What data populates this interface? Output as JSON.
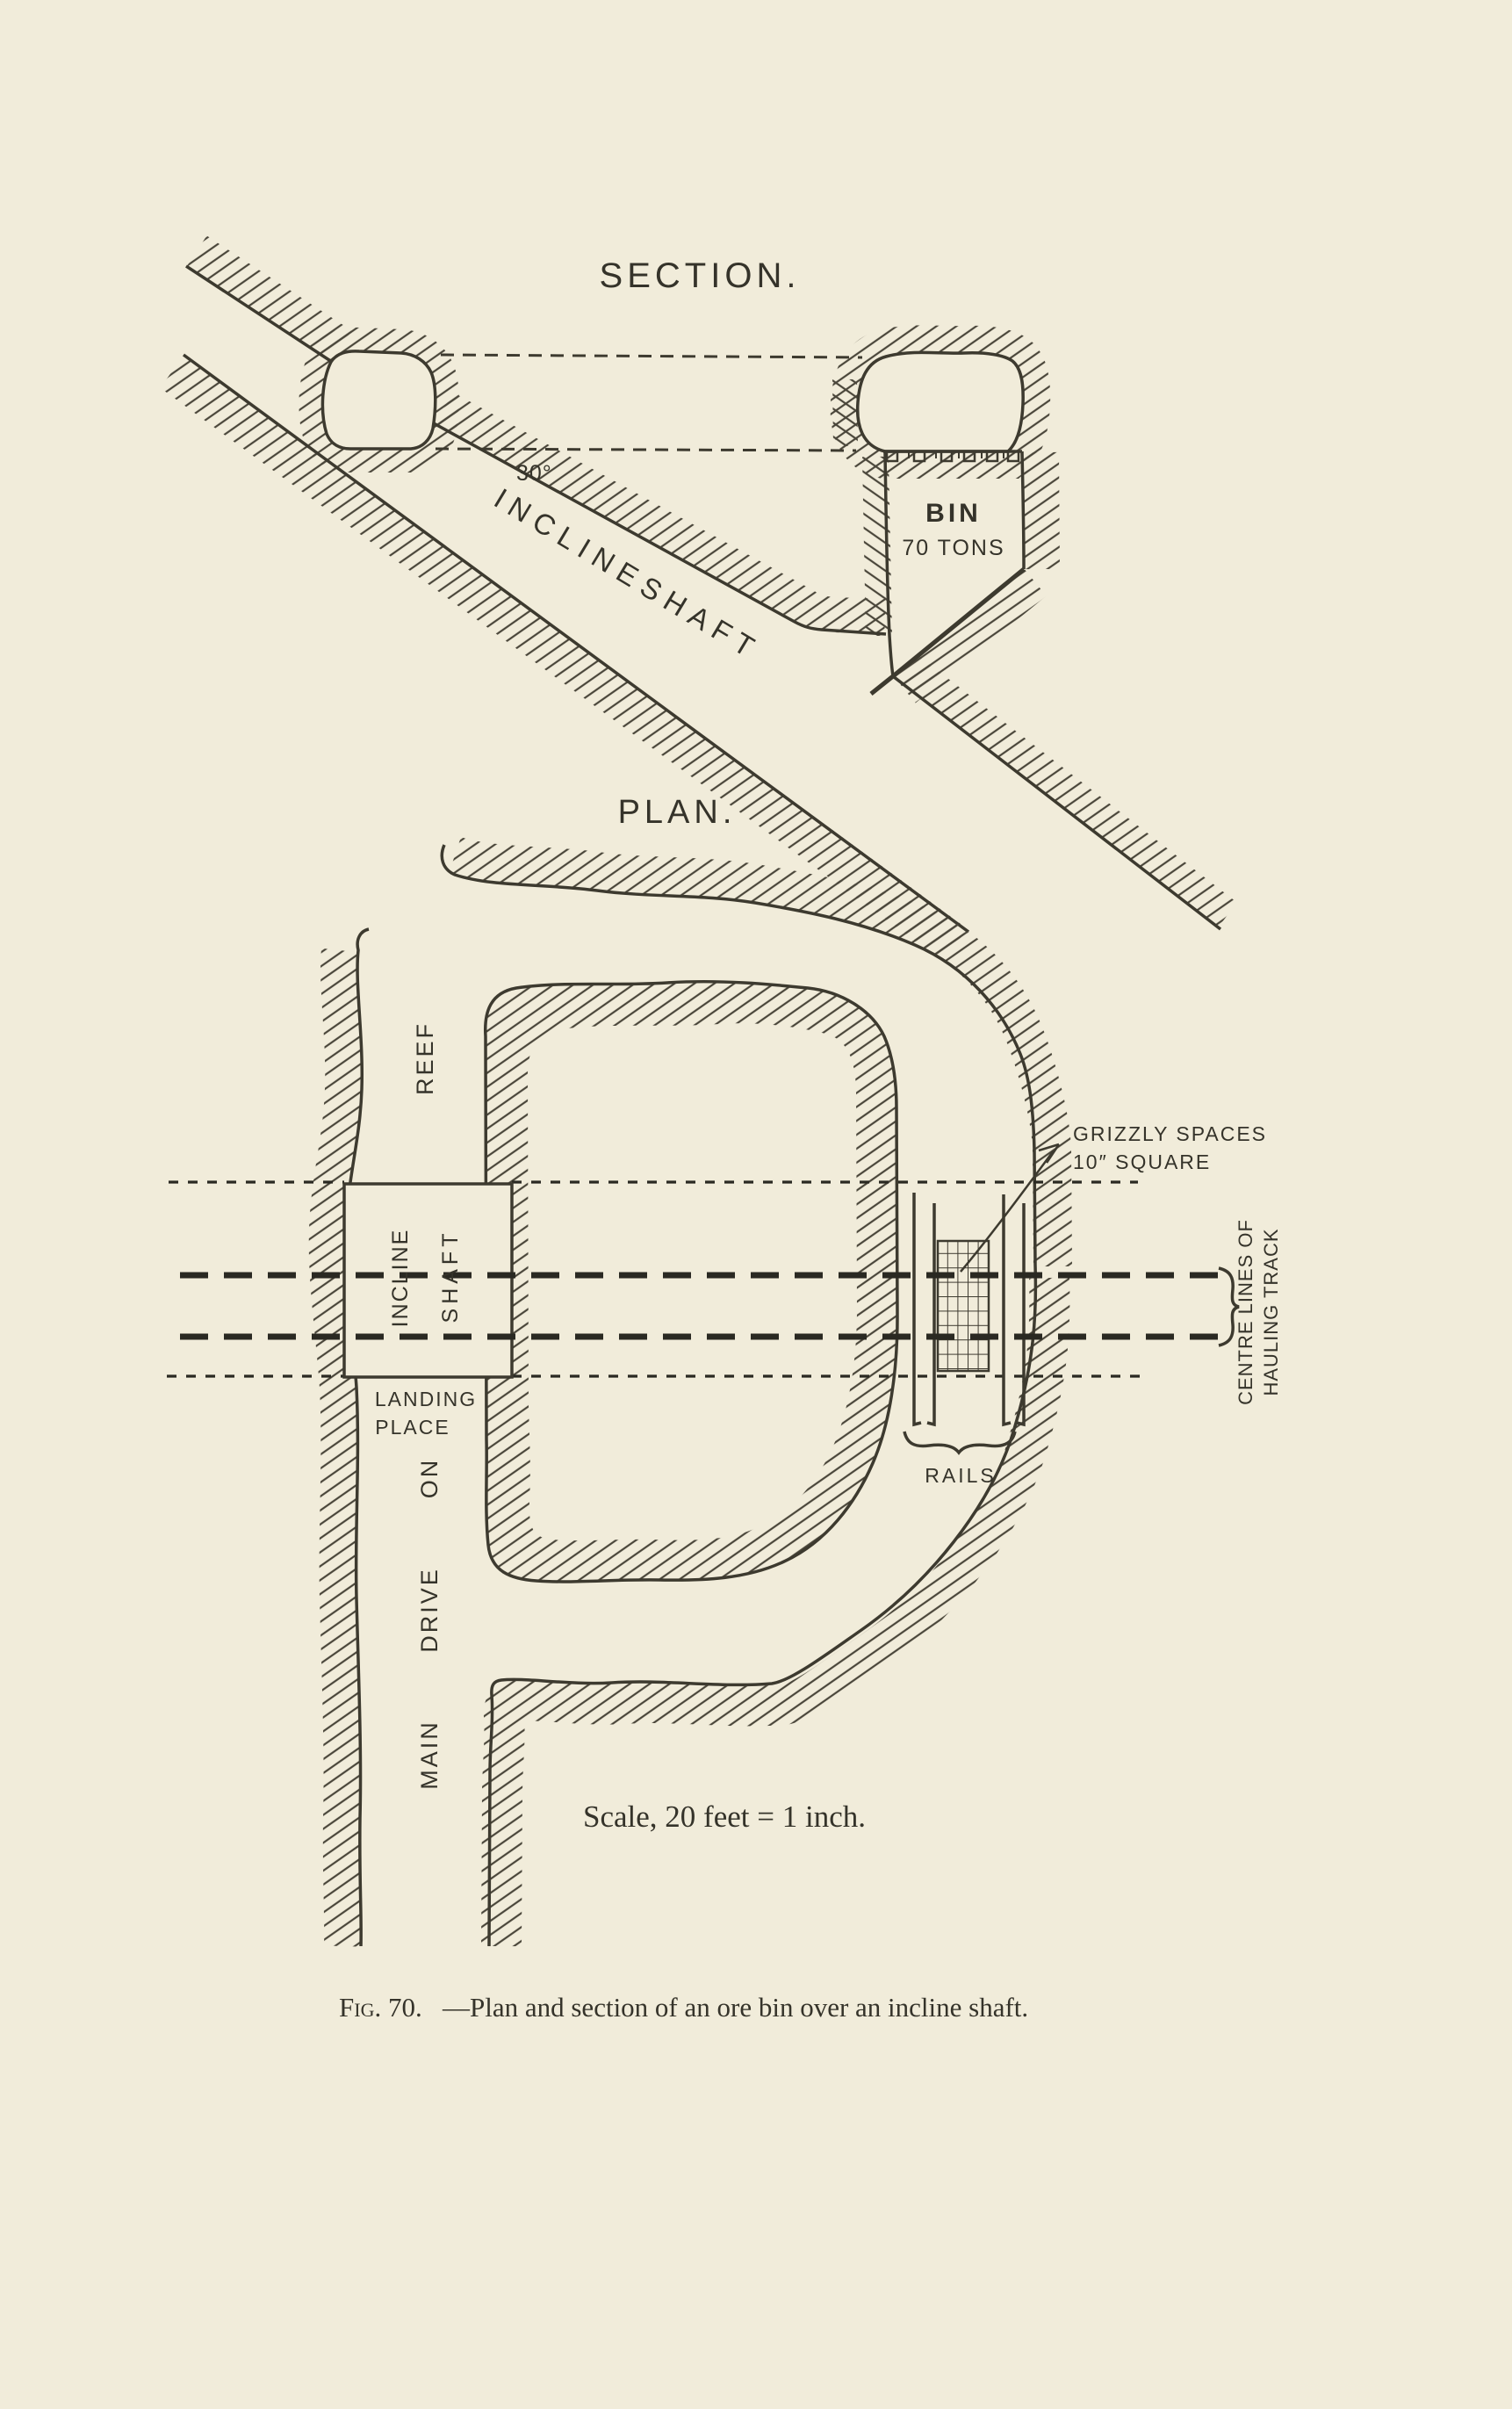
{
  "section": {
    "title": "SECTION.",
    "angle_label": "30°",
    "shaft_word1": "INCLINE",
    "shaft_word2": "SHAFT",
    "bin_label": "BIN",
    "bin_capacity": "70 TONS"
  },
  "plan": {
    "title": "PLAN.",
    "reef_label": "REEF",
    "shaft_box_word1": "INCLINE",
    "shaft_box_word2": "SHAFT",
    "landing_word1": "LANDING",
    "landing_word2": "PLACE",
    "drive_word_top": "ON",
    "drive_word_mid": "DRIVE",
    "drive_word_bottom": "MAIN",
    "grizzly_note_line1": "GRIZZLY SPACES",
    "grizzly_note_line2": "10″ SQUARE",
    "centre_lines_line1": "CENTRE LINES OF",
    "centre_lines_line2": "HAULING TRACK",
    "rails_label": "RAILS"
  },
  "scale_note": "Scale, 20 feet = 1 inch.",
  "caption": {
    "prefix": "Fig. 70.",
    "text": "—Plan and section of an ore bin over an incline shaft."
  },
  "colors": {
    "paper": "#f1ecda",
    "ink": "#3d3a2f",
    "hatch": "#4a463a",
    "dash": "#2a2922"
  }
}
